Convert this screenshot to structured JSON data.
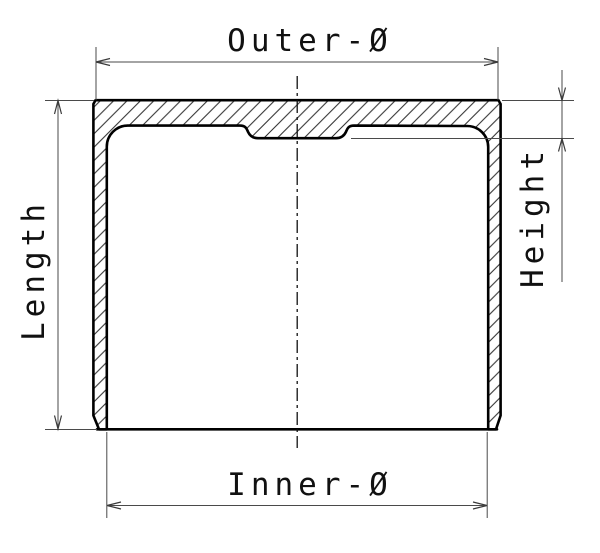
{
  "diagram": {
    "labels": {
      "outer_diameter": "Outer-Ø",
      "inner_diameter": "Inner-Ø",
      "length": "Length",
      "height": "Height"
    },
    "colors": {
      "background": "#ffffff",
      "part_outline": "#000000",
      "hatch_lines": "#2a2a2a",
      "dimension_lines": "#4a4a4a",
      "label_text": "#111111"
    }
  }
}
